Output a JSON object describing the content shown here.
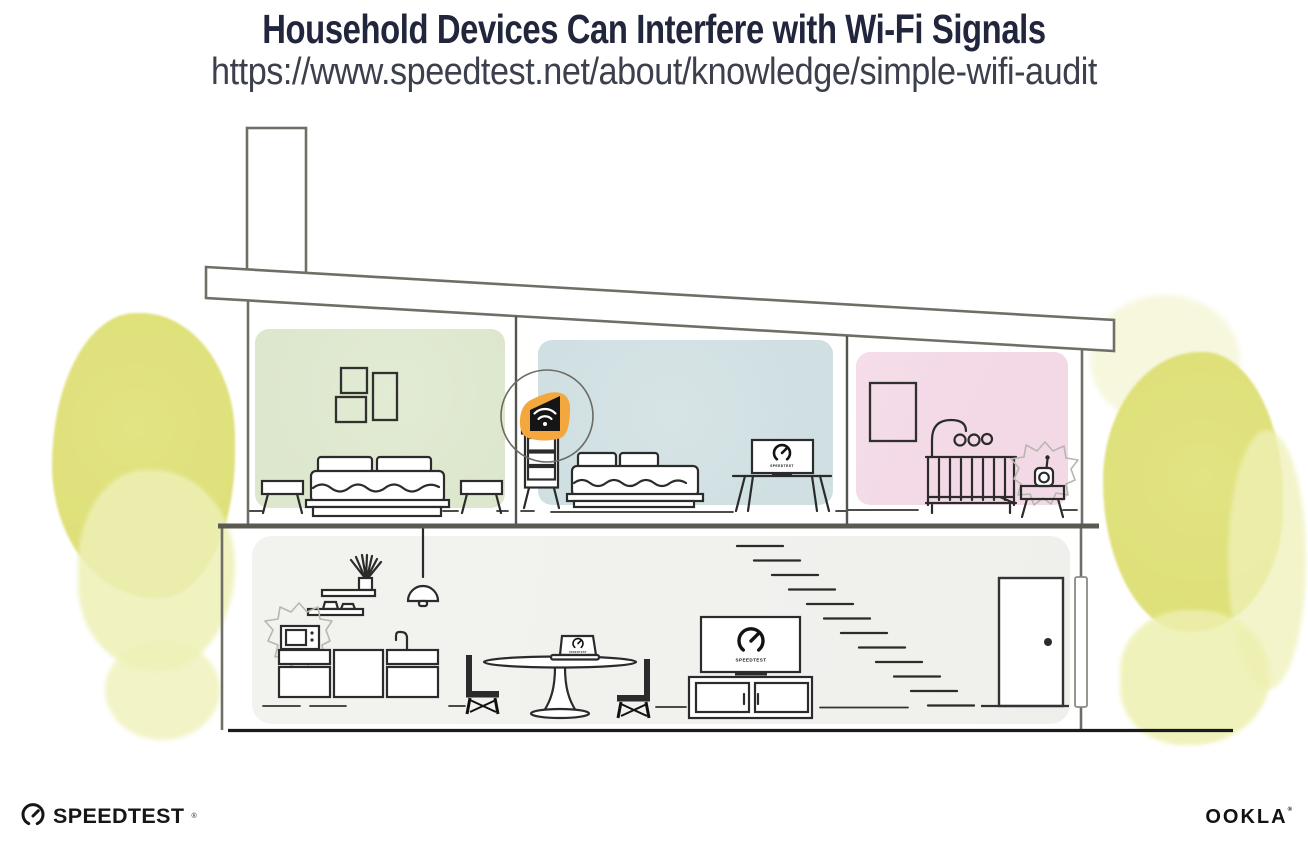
{
  "header": {
    "title": "Household Devices Can Interfere with Wi-Fi Signals",
    "subtitle_url": "https://www.speedtest.net/about/knowledge/simple-wifi-audit"
  },
  "device_screens": {
    "bedroom_tv_label": "SPEEDTEST",
    "dining_laptop_label": "SPEEDTEST",
    "living_room_tv_label": "SPEEDTEST"
  },
  "footer": {
    "speedtest_wordmark": "SPEEDTEST",
    "speedtest_registered_mark": "®",
    "ookla_wordmark": "OOKLA",
    "ookla_registered_mark": "®"
  },
  "illustration": {
    "colors": {
      "title_text": "#21263d",
      "subtitle_text": "#3b404c",
      "structure_line": "#6f6f67",
      "furniture_line": "#2b2b2b",
      "master_bedroom_wall": "#dde7cd",
      "second_bedroom_wall": "#cfdfe2",
      "nursery_wall": "#f3d8e6",
      "ground_floor_wall": "#f1f1ee",
      "foliage_yellow": "#dfe07c",
      "foliage_yellow_light": "#eef0b6",
      "router_highlight_orange": "#f3a73c",
      "interference_scribble": "#b7b7b0"
    }
  }
}
